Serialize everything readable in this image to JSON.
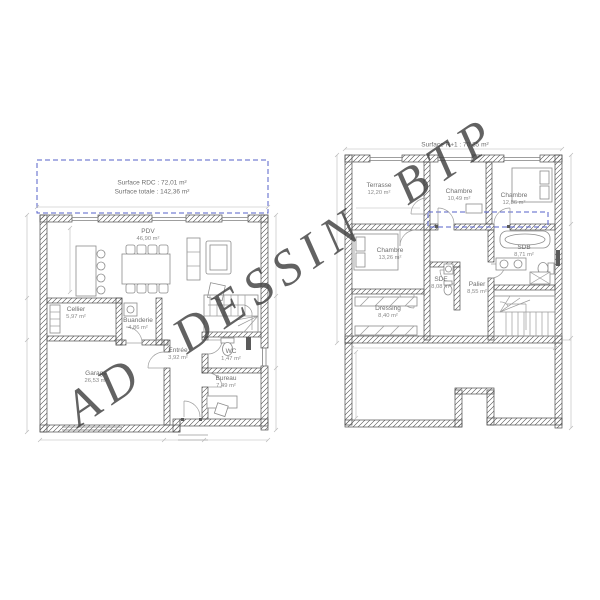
{
  "watermark": "AD DESSIN BTP",
  "colors": {
    "dashed_projection": "#5661c9",
    "wall_line": "#4f4f4f",
    "drawing_line": "#9a9a9a",
    "label_text": "#6f6f6f",
    "watermark_gray": "#404040"
  },
  "rdc": {
    "surface_rdc": "Surface RDC : 72,01 m²",
    "surface_totale": "Surface totale : 142,36 m²",
    "rooms": [
      {
        "name": "PDV",
        "area": "46,90 m²"
      },
      {
        "name": "Cellier",
        "area": "5,97 m²"
      },
      {
        "name": "Buanderie",
        "area": "4,86 m²"
      },
      {
        "name": "Entrée",
        "area": "3,92 m²"
      },
      {
        "name": "WC",
        "area": "1,47 m²"
      },
      {
        "name": "Bureau",
        "area": "7,49 m²"
      },
      {
        "name": "Garage",
        "area": "26,53 m²"
      }
    ]
  },
  "r1": {
    "surface_r1": "Surface R+1 : 70,35 m²",
    "rooms": [
      {
        "name": "Terrasse",
        "area": "12,20 m²"
      },
      {
        "name": "Chambre",
        "area": "10,49 m²"
      },
      {
        "name": "Chambre",
        "area": "12,86 m²"
      },
      {
        "name": "Chambre",
        "area": "13,26 m²"
      },
      {
        "name": "Dressing",
        "area": "8,40 m²"
      },
      {
        "name": "SDE",
        "area": "8,08 m²"
      },
      {
        "name": "Palier",
        "area": "8,55 m²"
      },
      {
        "name": "SDB",
        "area": "8,71 m²"
      }
    ]
  }
}
